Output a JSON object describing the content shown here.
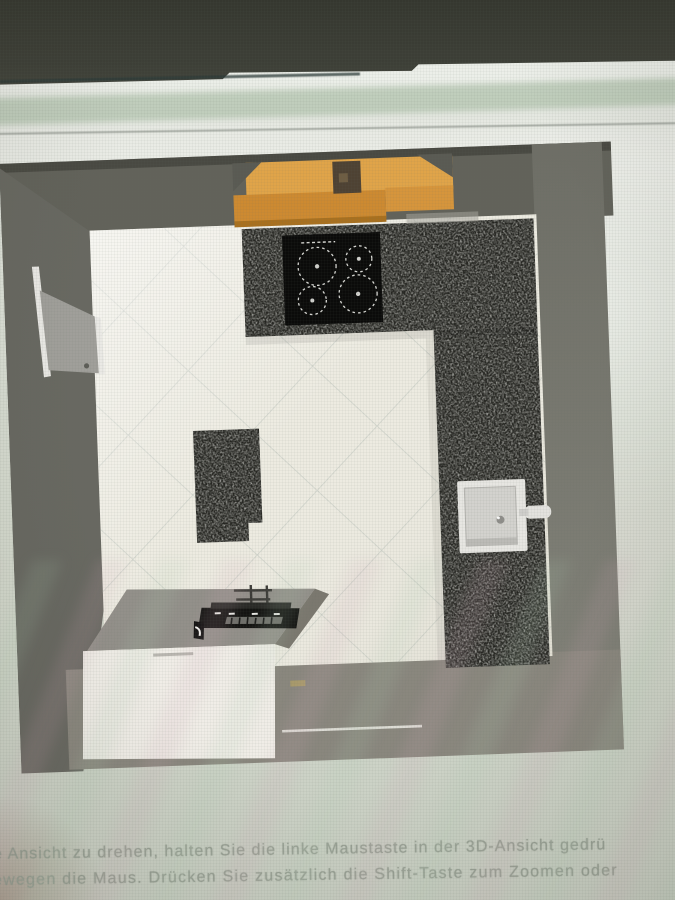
{
  "instructions": {
    "line1": "e Ansicht zu drehen, halten Sie die linke Maustaste in der 3D-Ansicht gedrü",
    "line2": "ewegen die Maus. Drücken Sie zusätzlich die Shift-Taste zum Zoomen oder"
  },
  "colors": {
    "bezel": "#3a3c34",
    "canvas": "#d5dacf",
    "wall_top": "#62625a",
    "wall_left": "#686861",
    "wall_right": "#7b7b73",
    "wall_bottom": "#8a877e",
    "floor": "#edebe1",
    "tile_line": "#c9cec6",
    "granite": "#23231f",
    "cooktop": "#0b0b0a",
    "burner_ring": "#d8d8d4",
    "hood_top": "#e0a449",
    "hood_front": "#cd8a31",
    "hood_bracket": "#4e4233",
    "island_top": "#93908a",
    "island_side": "#7b786f",
    "island_front": "#f0ede7",
    "appliance": "#141412",
    "sink_outer": "#e7e6e2",
    "sink_inner": "#d3d2ce",
    "door": "#a09f9a",
    "door_frame": "#eae9e5",
    "text": "#98a094"
  }
}
